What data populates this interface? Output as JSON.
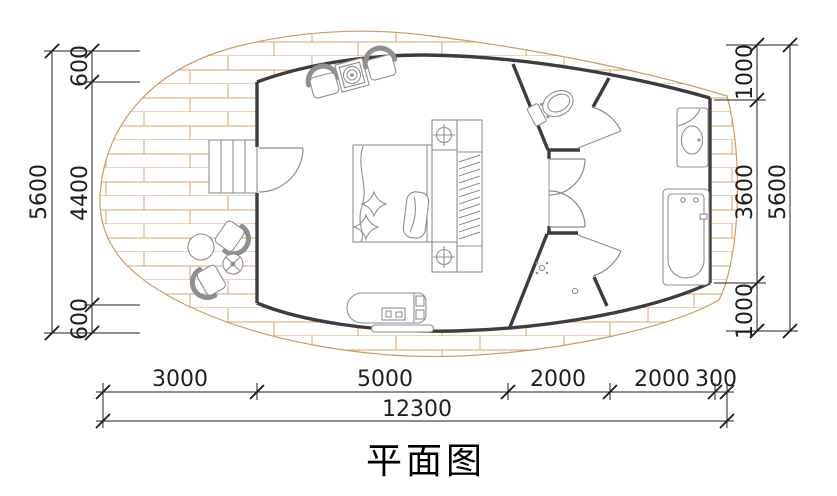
{
  "title": "平面图",
  "dims": {
    "left": {
      "overall": "5600",
      "segments": [
        "600",
        "4400",
        "600"
      ]
    },
    "right": {
      "overall": "5600",
      "segments": [
        "1000",
        "3600",
        "1000"
      ]
    },
    "bottom": {
      "overall": "12300",
      "segments": [
        "3000",
        "5000",
        "2000",
        "2000",
        "300"
      ]
    }
  },
  "colors": {
    "wall": "#3d3d3d",
    "furniture": "#8f8f8f",
    "deck": "#d09a60",
    "dimension": "#1f1f1f"
  },
  "elements": {
    "deck": "wood-deck",
    "entry_steps": "entry-steps",
    "bedroom": [
      "armchair",
      "plant-table",
      "armchair",
      "bed",
      "nightstand-lamp",
      "wardrobe",
      "chaise-bench"
    ],
    "bathroom": [
      "toilet",
      "washbasin",
      "bathtub",
      "shower-head",
      "floor-drain"
    ],
    "outdoor": [
      "deck-armchair",
      "round-table",
      "potted-plant"
    ]
  }
}
